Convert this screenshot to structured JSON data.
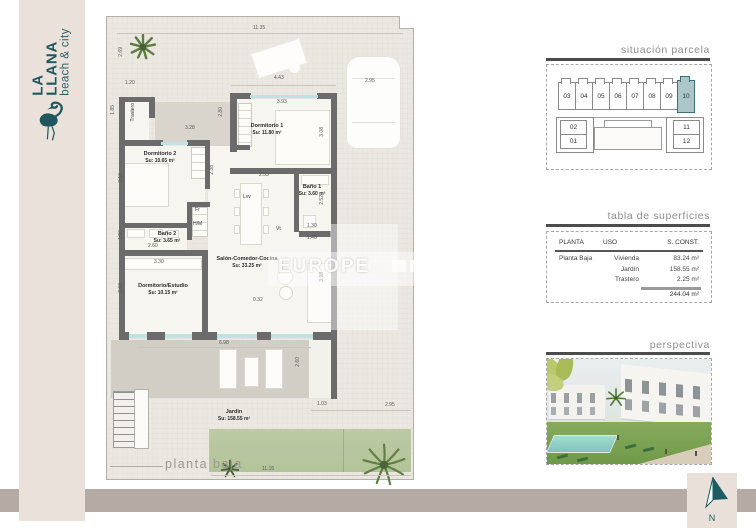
{
  "brand": {
    "name_line1": "LA",
    "name_line2": "LLANA",
    "tagline": "beach & city",
    "accent_color": "#20565d",
    "strip_color": "#e9e1da"
  },
  "plan": {
    "caption": "planta baja",
    "watermark": "EUROPE",
    "wall_color": "#6b6b6b",
    "window_color": "#bfe3e4",
    "room_labels": [
      {
        "name": "Dormitorio 1",
        "area": "Su: 11.80 m²",
        "x": 160,
        "y": 112
      },
      {
        "name": "Dormitorio 2",
        "area": "Su: 10.65 m²",
        "x": 53,
        "y": 140
      },
      {
        "name": "Baño 1",
        "area": "Su: 3.60 m²",
        "x": 205,
        "y": 173
      },
      {
        "name": "Baño 2",
        "area": "Su: 3.65 m²",
        "x": 60,
        "y": 220
      },
      {
        "name": "Dormitorio/Estudio",
        "area": "Su: 10.15 m²",
        "x": 56,
        "y": 272
      },
      {
        "name": "Salón-Comedor-Cocina",
        "area": "Su: 33.25 m²",
        "x": 140,
        "y": 245
      },
      {
        "name": "Jardín",
        "area": "Su: 158.55 m²",
        "x": 127,
        "y": 398
      }
    ],
    "small_labels": [
      {
        "t": "Trastero",
        "x": 24,
        "y": 86,
        "v": 1
      },
      {
        "t": "Lvv",
        "x": 136,
        "y": 178
      },
      {
        "t": "Fr",
        "x": 88,
        "y": 191
      },
      {
        "t": "H/M",
        "x": 86,
        "y": 205
      },
      {
        "t": "Vt",
        "x": 169,
        "y": 210
      }
    ],
    "dimensions": [
      {
        "t": "11.35",
        "x": 146,
        "y": 9
      },
      {
        "t": "2.69",
        "x": 12,
        "y": 30,
        "v": 1
      },
      {
        "t": "4.43",
        "x": 167,
        "y": 59
      },
      {
        "t": "2.95",
        "x": 258,
        "y": 62
      },
      {
        "t": "1.20",
        "x": 18,
        "y": 64
      },
      {
        "t": "1.85",
        "x": 4,
        "y": 88,
        "v": 1
      },
      {
        "t": "3.28",
        "x": 78,
        "y": 109
      },
      {
        "t": "2.80",
        "x": 112,
        "y": 90,
        "v": 1
      },
      {
        "t": "3.93",
        "x": 170,
        "y": 83
      },
      {
        "t": "3.08",
        "x": 213,
        "y": 110,
        "v": 1
      },
      {
        "t": "3.10",
        "x": 12,
        "y": 156,
        "v": 1
      },
      {
        "t": "2.38",
        "x": 103,
        "y": 148,
        "v": 1
      },
      {
        "t": "2.53",
        "x": 152,
        "y": 156
      },
      {
        "t": "2.52",
        "x": 213,
        "y": 178,
        "v": 1
      },
      {
        "t": "1.30",
        "x": 200,
        "y": 207
      },
      {
        "t": "1.40",
        "x": 200,
        "y": 219
      },
      {
        "t": "1.50",
        "x": 12,
        "y": 213,
        "v": 1
      },
      {
        "t": "2.60",
        "x": 41,
        "y": 227
      },
      {
        "t": "3.30",
        "x": 47,
        "y": 243
      },
      {
        "t": "3.08",
        "x": 12,
        "y": 266,
        "v": 1
      },
      {
        "t": "3.98",
        "x": 213,
        "y": 255,
        "v": 1
      },
      {
        "t": "0.32",
        "x": 146,
        "y": 281
      },
      {
        "t": "6.98",
        "x": 112,
        "y": 324
      },
      {
        "t": "2.60",
        "x": 189,
        "y": 340,
        "v": 1
      },
      {
        "t": "1.03",
        "x": 210,
        "y": 385
      },
      {
        "t": "2.95",
        "x": 278,
        "y": 386
      },
      {
        "t": "11.15",
        "x": 155,
        "y": 450
      }
    ]
  },
  "panels": {
    "parcel": {
      "title": "situación parcela",
      "row_units": [
        "03",
        "04",
        "05",
        "06",
        "07",
        "08",
        "09",
        "10"
      ],
      "left_units": [
        "02",
        "01"
      ],
      "right_units": [
        "11",
        "12"
      ],
      "highlighted_unit": "10",
      "highlight_color": "#abc6c7"
    },
    "surfaces": {
      "title": "tabla de superficies",
      "columns": [
        "PLANTA",
        "USO",
        "S. CONST."
      ],
      "rows": [
        [
          "Planta Baja",
          "Vivienda",
          "83.24 m²"
        ],
        [
          "",
          "Jardín",
          "158.55 m²"
        ],
        [
          "",
          "Trastero",
          "2.25 m²"
        ]
      ],
      "total": "244.04 m²"
    },
    "perspective": {
      "title": "perspectiva"
    }
  },
  "compass": {
    "label": "N"
  }
}
